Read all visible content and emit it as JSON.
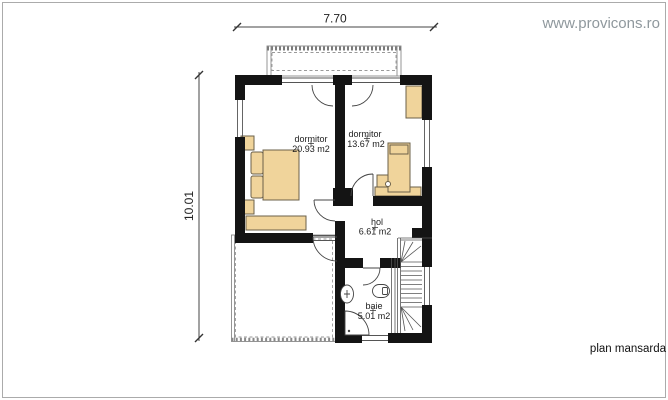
{
  "page": {
    "watermark": "www.provicons.ro",
    "plan_label": "plan mansarda"
  },
  "dimensions": {
    "top": "7.70",
    "left": "10.01"
  },
  "rooms": {
    "bedroom1": {
      "name": "dormitor",
      "area": "20.93 m2"
    },
    "bedroom2": {
      "name": "dormitor",
      "area": "13.67 m2"
    },
    "hall": {
      "name": "hol",
      "area": "6.61 m2"
    },
    "bathroom": {
      "name": "baie",
      "area": "5.01 m2"
    }
  },
  "colors": {
    "wall": "#141414",
    "furniture": "#F0D49B",
    "furniture_outline": "#6b604a",
    "watermark": "#8f989d",
    "frame_border": "#ababab"
  }
}
